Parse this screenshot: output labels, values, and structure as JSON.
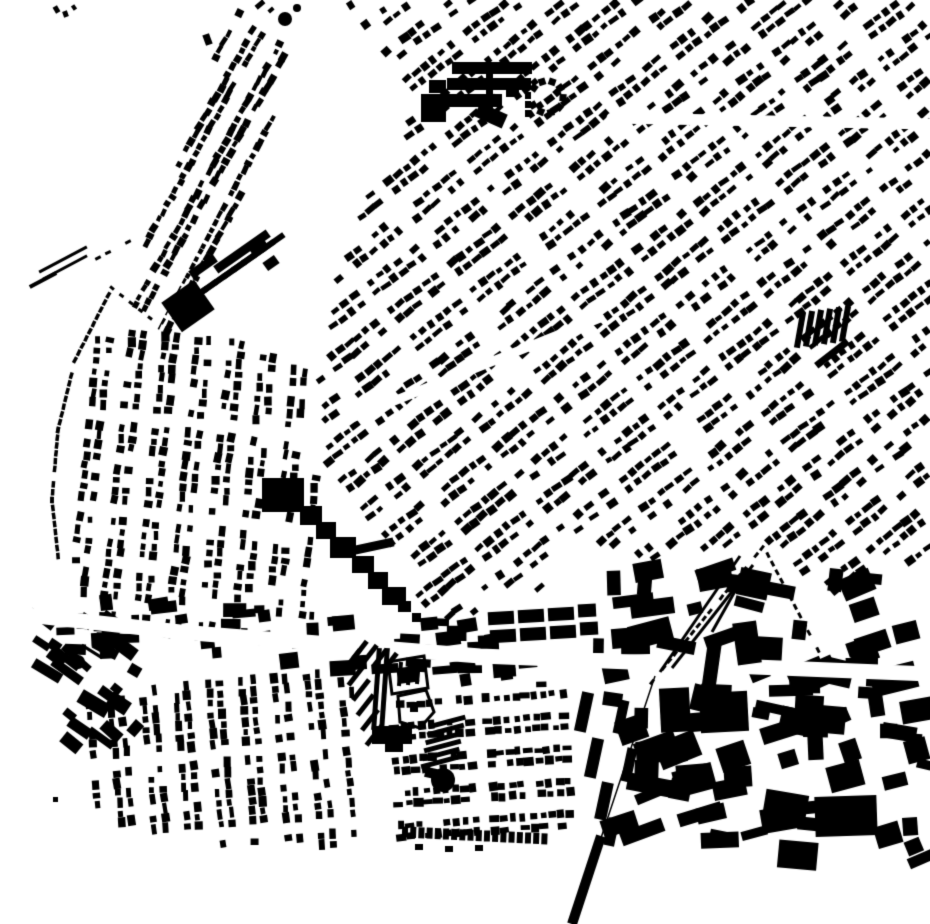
{
  "map": {
    "kind": "figure-ground building footprint map",
    "background": "#ffffff",
    "ink": "#000000",
    "width": 930,
    "height": 924,
    "seed": 1337
  },
  "districts": [
    {
      "name": "ne-grid",
      "poly": [
        [
          340,
          0
        ],
        [
          930,
          0
        ],
        [
          930,
          552
        ],
        [
          845,
          598
        ],
        [
          755,
          540
        ],
        [
          640,
          562
        ],
        [
          560,
          530
        ],
        [
          545,
          588
        ],
        [
          470,
          615
        ],
        [
          425,
          620
        ],
        [
          405,
          560
        ],
        [
          330,
          478
        ],
        [
          318,
          395
        ],
        [
          330,
          300
        ],
        [
          360,
          215
        ],
        [
          420,
          95
        ]
      ],
      "angle": -38,
      "rowPitch": 11.5,
      "colPitch": 11,
      "rowCycle": 3,
      "rowsOn": 2,
      "colPeriod": 7,
      "colGap": 1,
      "w": 8,
      "h": 6,
      "density": 0.85,
      "jitterA": 12
    },
    {
      "name": "nw-wedge",
      "poly": [
        [
          232,
          6
        ],
        [
          300,
          52
        ],
        [
          240,
          200
        ],
        [
          168,
          332
        ],
        [
          122,
          302
        ],
        [
          180,
          160
        ]
      ],
      "angle": -61,
      "rowPitch": 10,
      "colPitch": 8.5,
      "rowCycle": 3,
      "rowsOn": 2,
      "colPeriod": 40,
      "colGap": 0,
      "w": 7,
      "h": 5.5,
      "density": 0.92,
      "jitterA": 10
    },
    {
      "name": "west-mid-curvy",
      "poly": [
        [
          88,
          332
        ],
        [
          205,
          330
        ],
        [
          305,
          362
        ],
        [
          318,
          478
        ],
        [
          312,
          622
        ],
        [
          205,
          638
        ],
        [
          95,
          625
        ],
        [
          72,
          560
        ]
      ],
      "angle": 96,
      "rowPitch": 11,
      "colPitch": 10.5,
      "rowCycle": 3,
      "rowsOn": 2,
      "colPeriod": 9,
      "colGap": 1,
      "w": 7.5,
      "h": 6,
      "density": 0.8,
      "jitterA": 14
    },
    {
      "name": "sw-residential",
      "poly": [
        [
          82,
          698
        ],
        [
          350,
          662
        ],
        [
          362,
          845
        ],
        [
          232,
          848
        ],
        [
          98,
          818
        ]
      ],
      "angle": 85,
      "rowPitch": 11,
      "colPitch": 10,
      "rowCycle": 3,
      "rowsOn": 2,
      "colPeriod": 8,
      "colGap": 1,
      "w": 8,
      "h": 6,
      "density": 0.85,
      "jitterA": 10
    },
    {
      "name": "south-center-terraces",
      "poly": [
        [
          382,
          700
        ],
        [
          565,
          682
        ],
        [
          576,
          842
        ],
        [
          398,
          848
        ]
      ],
      "angle": -4,
      "rowPitch": 11,
      "colPitch": 9.5,
      "rowCycle": 3,
      "rowsOn": 2,
      "colPeriod": 10,
      "colGap": 1,
      "w": 7.5,
      "h": 6.5,
      "density": 0.85,
      "jitterA": 8
    }
  ],
  "clusters": [
    {
      "name": "se-industrial",
      "poly": [
        [
          612,
          565
        ],
        [
          930,
          580
        ],
        [
          930,
          858
        ],
        [
          700,
          868
        ],
        [
          612,
          835
        ]
      ],
      "count": 95,
      "wMin": 13,
      "wMax": 46,
      "hMin": 9,
      "hMax": 28,
      "angle": -4,
      "jitterA": 40
    },
    {
      "name": "gasworks-yard",
      "poly": [
        [
          24,
          612
        ],
        [
          142,
          594
        ],
        [
          152,
          742
        ],
        [
          38,
          748
        ]
      ],
      "count": 24,
      "wMin": 10,
      "wMax": 36,
      "hMin": 7,
      "hMax": 17,
      "angle": 35,
      "jitterA": 14
    },
    {
      "name": "main-road-frontage",
      "poly": [
        [
          60,
          588
        ],
        [
          600,
          636
        ],
        [
          602,
          694
        ],
        [
          420,
          682
        ],
        [
          60,
          652
        ]
      ],
      "count": 55,
      "wMin": 9,
      "wMax": 27,
      "hMin": 7,
      "hMax": 16,
      "angle": -3,
      "jitterA": 14
    }
  ],
  "streets": [
    {
      "name": "main-road",
      "pts": [
        [
          0,
          612
        ],
        [
          180,
          632
        ],
        [
          480,
          656
        ],
        [
          930,
          674
        ]
      ],
      "w": 15
    },
    {
      "name": "ne-cross-street",
      "pts": [
        [
          612,
          118
        ],
        [
          930,
          124
        ]
      ],
      "w": 11
    },
    {
      "name": "wedge-road",
      "pts": [
        [
          302,
          42
        ],
        [
          152,
          330
        ]
      ],
      "w": 9
    },
    {
      "name": "central-diagonal",
      "pts": [
        [
          322,
          430
        ],
        [
          600,
          318
        ]
      ],
      "w": 9
    }
  ],
  "dash_lines": [
    {
      "name": "west-terrace-ribbon",
      "pts": [
        [
          112,
          288
        ],
        [
          75,
          360
        ],
        [
          58,
          430
        ],
        [
          52,
          500
        ],
        [
          58,
          556
        ]
      ],
      "step": 7.5,
      "w": 6.5,
      "h": 3.5,
      "density": 0.9
    },
    {
      "name": "west-terrace-ribbon-upper",
      "pts": [
        [
          128,
          242
        ],
        [
          98,
          258
        ]
      ],
      "step": 9,
      "w": 6,
      "h": 3,
      "density": 0.8
    },
    {
      "name": "west-terrace-link",
      "pts": [
        [
          150,
          318
        ],
        [
          112,
          288
        ]
      ],
      "step": 10,
      "w": 5,
      "h": 3,
      "density": 0.6
    }
  ],
  "landmarks": [
    {
      "t": "r",
      "x": 168,
      "y": 288,
      "w": 40,
      "h": 36,
      "a": -35
    },
    {
      "t": "teeth",
      "x": 196,
      "y": 296,
      "dx": 9.6,
      "dy": -6.7,
      "n": 9,
      "w": 6,
      "h": 27,
      "a": 55
    },
    {
      "t": "r",
      "x": 210,
      "y": 247,
      "w": 64,
      "h": 9,
      "a": -35
    },
    {
      "t": "r",
      "x": 250,
      "y": 242,
      "w": 18,
      "h": 12,
      "a": -35
    },
    {
      "t": "r",
      "x": 188,
      "y": 262,
      "w": 30,
      "h": 9,
      "a": -35
    },
    {
      "t": "r",
      "x": 264,
      "y": 258,
      "w": 14,
      "h": 10,
      "a": -35
    },
    {
      "t": "r",
      "x": 452,
      "y": 62,
      "w": 80,
      "h": 12,
      "a": 0
    },
    {
      "t": "r",
      "x": 447,
      "y": 78,
      "w": 84,
      "h": 12,
      "a": 0
    },
    {
      "t": "r",
      "x": 440,
      "y": 94,
      "w": 62,
      "h": 13,
      "a": 0
    },
    {
      "t": "r",
      "x": 486,
      "y": 62,
      "w": 7,
      "h": 56,
      "a": 0
    },
    {
      "t": "r",
      "x": 429,
      "y": 80,
      "w": 17,
      "h": 13,
      "a": 0
    },
    {
      "t": "r",
      "x": 421,
      "y": 94,
      "w": 25,
      "h": 28,
      "a": 0
    },
    {
      "t": "r",
      "x": 476,
      "y": 108,
      "w": 30,
      "h": 15,
      "a": 24
    },
    {
      "t": "r",
      "x": 506,
      "y": 87,
      "w": 13,
      "h": 10,
      "a": 0
    },
    {
      "t": "ringsq",
      "cx": 547,
      "cy": 97,
      "r": 16,
      "n": 9,
      "s": 7,
      "open": [
        150,
        215
      ]
    },
    {
      "t": "r",
      "x": 525,
      "y": 92,
      "w": 6,
      "h": 7,
      "a": 0
    },
    {
      "t": "r",
      "x": 525,
      "y": 101,
      "w": 6,
      "h": 7,
      "a": 0
    },
    {
      "t": "r",
      "x": 525,
      "y": 110,
      "w": 6,
      "h": 7,
      "a": 0
    },
    {
      "t": "r",
      "x": 262,
      "y": 478,
      "w": 42,
      "h": 34,
      "a": 0
    },
    {
      "t": "r",
      "x": 300,
      "y": 506,
      "w": 22,
      "h": 19,
      "a": 0
    },
    {
      "t": "r",
      "x": 316,
      "y": 522,
      "w": 20,
      "h": 17,
      "a": 0
    },
    {
      "t": "r",
      "x": 330,
      "y": 537,
      "w": 26,
      "h": 21,
      "a": 0
    },
    {
      "t": "r",
      "x": 352,
      "y": 556,
      "w": 22,
      "h": 17,
      "a": 0
    },
    {
      "t": "r",
      "x": 368,
      "y": 572,
      "w": 20,
      "h": 17,
      "a": 0
    },
    {
      "t": "r",
      "x": 382,
      "y": 587,
      "w": 24,
      "h": 18,
      "a": 0
    },
    {
      "t": "r",
      "x": 398,
      "y": 601,
      "w": 13,
      "h": 11,
      "a": 0
    },
    {
      "t": "r",
      "x": 350,
      "y": 542,
      "w": 44,
      "h": 9,
      "a": -12
    },
    {
      "t": "r",
      "x": 412,
      "y": 613,
      "w": 9,
      "h": 9,
      "a": 0
    },
    {
      "t": "c",
      "cx": 78,
      "cy": 662,
      "r": 7,
      "f": 1
    },
    {
      "t": "c",
      "cx": 103,
      "cy": 646,
      "r": 5,
      "f": 0,
      "sw": 2
    },
    {
      "t": "r",
      "x": 80,
      "y": 650,
      "w": 24,
      "h": 3,
      "a": 32
    },
    {
      "t": "teeth",
      "x": 800,
      "y": 330,
      "dx": 9,
      "dy": -1.2,
      "n": 6,
      "w": 6,
      "h": 36,
      "a": 10
    },
    {
      "t": "r",
      "x": 812,
      "y": 350,
      "w": 40,
      "h": 7,
      "a": -38
    },
    {
      "t": "teeth",
      "x": 352,
      "y": 660,
      "dx": 4.5,
      "dy": 15,
      "n": 6,
      "w": 26,
      "h": 5,
      "a": -52
    },
    {
      "t": "teeth",
      "x": 360,
      "y": 650,
      "dx": 10,
      "dy": 4,
      "n": 4,
      "w": 22,
      "h": 5,
      "a": -52
    },
    {
      "t": "r",
      "x": 374,
      "y": 648,
      "w": 5,
      "h": 82,
      "a": 4
    },
    {
      "t": "r",
      "x": 382,
      "y": 648,
      "w": 5,
      "h": 82,
      "a": 4
    },
    {
      "t": "hpoly",
      "pts": [
        [
          388,
          662
        ],
        [
          424,
          656
        ],
        [
          428,
          688
        ],
        [
          392,
          694
        ]
      ],
      "sw": 3
    },
    {
      "t": "teeth",
      "x": 400,
      "y": 674,
      "dx": 9,
      "dy": -1,
      "n": 3,
      "w": 4,
      "h": 24,
      "a": 5
    },
    {
      "t": "hpoly",
      "pts": [
        [
          398,
          696
        ],
        [
          426,
          690
        ],
        [
          434,
          712
        ],
        [
          420,
          728
        ],
        [
          400,
          722
        ]
      ],
      "sw": 3
    },
    {
      "t": "r",
      "x": 410,
      "y": 702,
      "w": 8,
      "h": 10,
      "a": 0
    },
    {
      "t": "r",
      "x": 372,
      "y": 726,
      "w": 40,
      "h": 18,
      "a": 0
    },
    {
      "t": "r",
      "x": 385,
      "y": 740,
      "w": 18,
      "h": 12,
      "a": 0
    },
    {
      "t": "teeth",
      "x": 447,
      "y": 722,
      "dx": -1.5,
      "dy": 8,
      "n": 6,
      "w": 38,
      "h": 5,
      "a": -15
    },
    {
      "t": "c",
      "cx": 443,
      "cy": 780,
      "r": 12,
      "f": 1
    },
    {
      "t": "r",
      "x": 425,
      "y": 768,
      "w": 12,
      "h": 10,
      "a": 12
    },
    {
      "t": "teeth",
      "x": 501,
      "y": 618,
      "dx": 30,
      "dy": -2,
      "n": 3,
      "w": 26,
      "h": 13,
      "a": -3
    },
    {
      "t": "teeth",
      "x": 503,
      "y": 636,
      "dx": 30,
      "dy": -2,
      "n": 3,
      "w": 26,
      "h": 13,
      "a": -3
    },
    {
      "t": "r",
      "x": 578,
      "y": 604,
      "w": 18,
      "h": 13,
      "a": -3
    },
    {
      "t": "r",
      "x": 580,
      "y": 622,
      "w": 18,
      "h": 13,
      "a": -3
    },
    {
      "t": "r",
      "x": 578,
      "y": 692,
      "w": 12,
      "h": 40,
      "a": 12
    },
    {
      "t": "r",
      "x": 588,
      "y": 738,
      "w": 12,
      "h": 40,
      "a": 12
    },
    {
      "t": "r",
      "x": 598,
      "y": 782,
      "w": 12,
      "h": 38,
      "a": 12
    },
    {
      "t": "r",
      "x": 606,
      "y": 818,
      "w": 11,
      "h": 28,
      "a": 12
    },
    {
      "t": "r",
      "x": 616,
      "y": 700,
      "w": 10,
      "h": 34,
      "a": 12
    },
    {
      "t": "r",
      "x": 624,
      "y": 748,
      "w": 10,
      "h": 34,
      "a": 12
    },
    {
      "t": "r",
      "x": 735,
      "y": 622,
      "w": 24,
      "h": 42,
      "a": -8
    },
    {
      "t": "r",
      "x": 705,
      "y": 638,
      "w": 14,
      "h": 50,
      "a": 8
    },
    {
      "t": "r",
      "x": 815,
      "y": 796,
      "w": 62,
      "h": 40,
      "a": -2
    },
    {
      "t": "r",
      "x": 700,
      "y": 692,
      "w": 48,
      "h": 40,
      "a": -3
    },
    {
      "t": "r",
      "x": 660,
      "y": 688,
      "w": 30,
      "h": 44,
      "a": -3
    },
    {
      "t": "teeth",
      "x": 405,
      "y": 832,
      "dx": 8.2,
      "dy": 0.4,
      "n": 18,
      "w": 6,
      "h": 11,
      "a": 2
    },
    {
      "t": "r",
      "x": 415,
      "y": 844,
      "w": 8,
      "h": 6,
      "a": 0
    },
    {
      "t": "r",
      "x": 445,
      "y": 846,
      "w": 8,
      "h": 6,
      "a": 0
    },
    {
      "t": "r",
      "x": 475,
      "y": 845,
      "w": 8,
      "h": 6,
      "a": 0
    },
    {
      "t": "c",
      "cx": 285,
      "cy": 19,
      "r": 7,
      "f": 1
    },
    {
      "t": "c",
      "cx": 297,
      "cy": 8,
      "r": 4,
      "f": 1
    },
    {
      "t": "r",
      "x": 54,
      "y": 6,
      "w": 5,
      "h": 7,
      "a": -30
    },
    {
      "t": "r",
      "x": 63,
      "y": 11,
      "w": 5,
      "h": 6,
      "a": -20
    },
    {
      "t": "r",
      "x": 72,
      "y": 5,
      "w": 4,
      "h": 5,
      "a": -35
    },
    {
      "t": "r",
      "x": 204,
      "y": 34,
      "w": 7,
      "h": 11,
      "a": -20
    },
    {
      "t": "r",
      "x": 53,
      "y": 797,
      "w": 5,
      "h": 5,
      "a": 0
    },
    {
      "t": "r",
      "x": 255,
      "y": 2,
      "w": 10,
      "h": 5,
      "a": -40
    },
    {
      "t": "r",
      "x": 268,
      "y": 8,
      "w": 6,
      "h": 4,
      "a": -40
    },
    {
      "t": "r",
      "x": 36,
      "y": 258,
      "w": 54,
      "h": 3,
      "a": -28
    },
    {
      "t": "r",
      "x": 40,
      "y": 266,
      "w": 50,
      "h": 3,
      "a": -28
    },
    {
      "t": "r",
      "x": 28,
      "y": 278,
      "w": 30,
      "h": 4,
      "a": -28
    }
  ],
  "railway": {
    "lines": [
      {
        "x1": 740,
        "y1": 556,
        "x2": 660,
        "y2": 672,
        "w": 3
      },
      {
        "x1": 753,
        "y1": 565,
        "x2": 672,
        "y2": 668,
        "w": 3
      },
      {
        "x1": 748,
        "y1": 568,
        "x2": 712,
        "y2": 632,
        "w": 3
      },
      {
        "x1": 655,
        "y1": 676,
        "x2": 601,
        "y2": 838,
        "w": 1.5
      },
      {
        "x1": 601,
        "y1": 836,
        "x2": 572,
        "y2": 924,
        "w": 10
      }
    ],
    "dashes": [
      {
        "pts": [
          [
            762,
            548
          ],
          [
            652,
            682
          ]
        ],
        "step": 9,
        "w": 6,
        "h": 3,
        "density": 0.85
      },
      {
        "pts": [
          [
            768,
            555
          ],
          [
            818,
            650
          ]
        ],
        "step": 9,
        "w": 6,
        "h": 3,
        "density": 0.8
      }
    ]
  }
}
